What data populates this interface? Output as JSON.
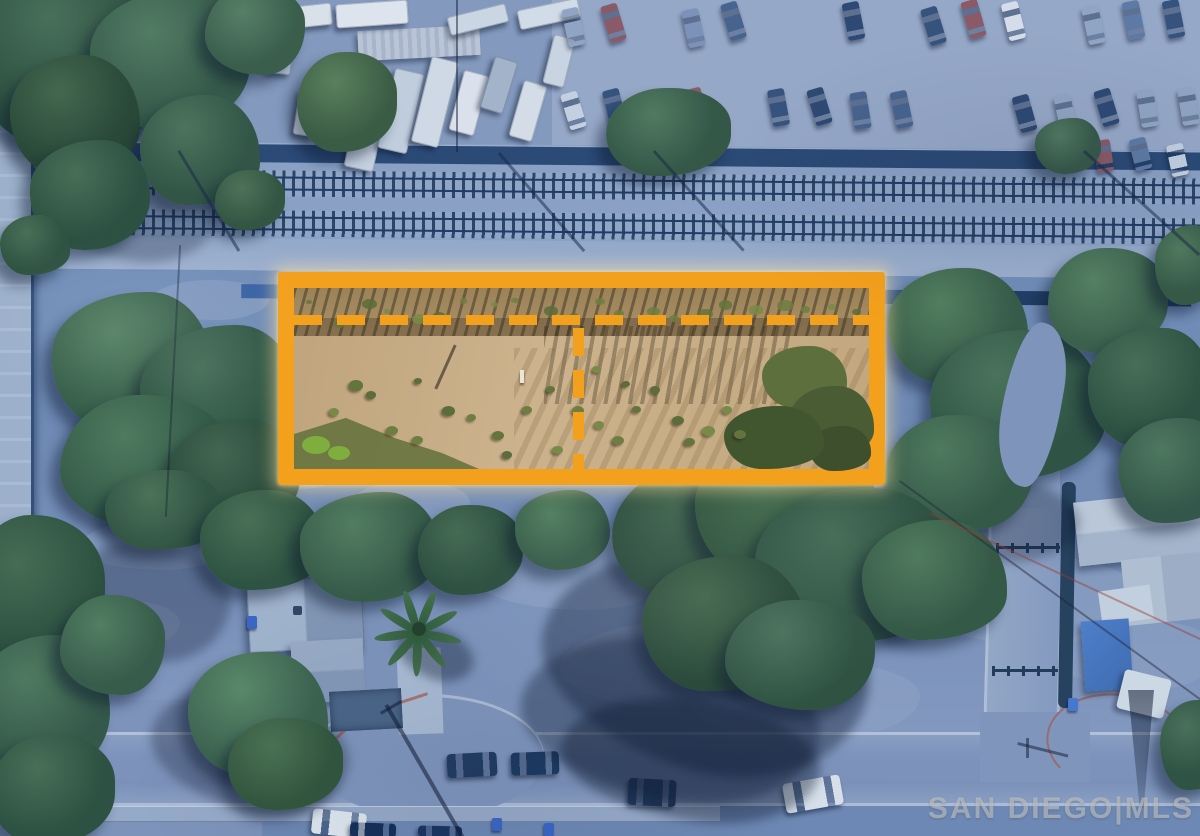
{
  "watermark": {
    "text": "SAN DIEGO|MLS"
  },
  "highlight": {
    "border_color": "#F3A01C",
    "division_style": "dashed",
    "shape": "rectangle"
  },
  "colors": {
    "highlight-orange": "#F3A01C",
    "overlay-blue": "#6d88b4",
    "parcel-dirt": "#c3a87f",
    "street-gray": "#7e95bc",
    "tree-green": "#335847",
    "rail-dark": "#24416b",
    "watermark-gray": "#d0d0d0"
  },
  "features": [
    "aerial-photo",
    "blue-overlay-tint",
    "highlighted-vacant-parcel",
    "parcel-division-dashed-lines",
    "railroad-tracks",
    "vehicle-storage-yard",
    "car-parking-lot",
    "residential-street",
    "cul-de-sac",
    "house-with-gray-roof",
    "palm-tree",
    "eucalyptus-tree-shadow",
    "parked-cars",
    "mls-watermark"
  ]
}
